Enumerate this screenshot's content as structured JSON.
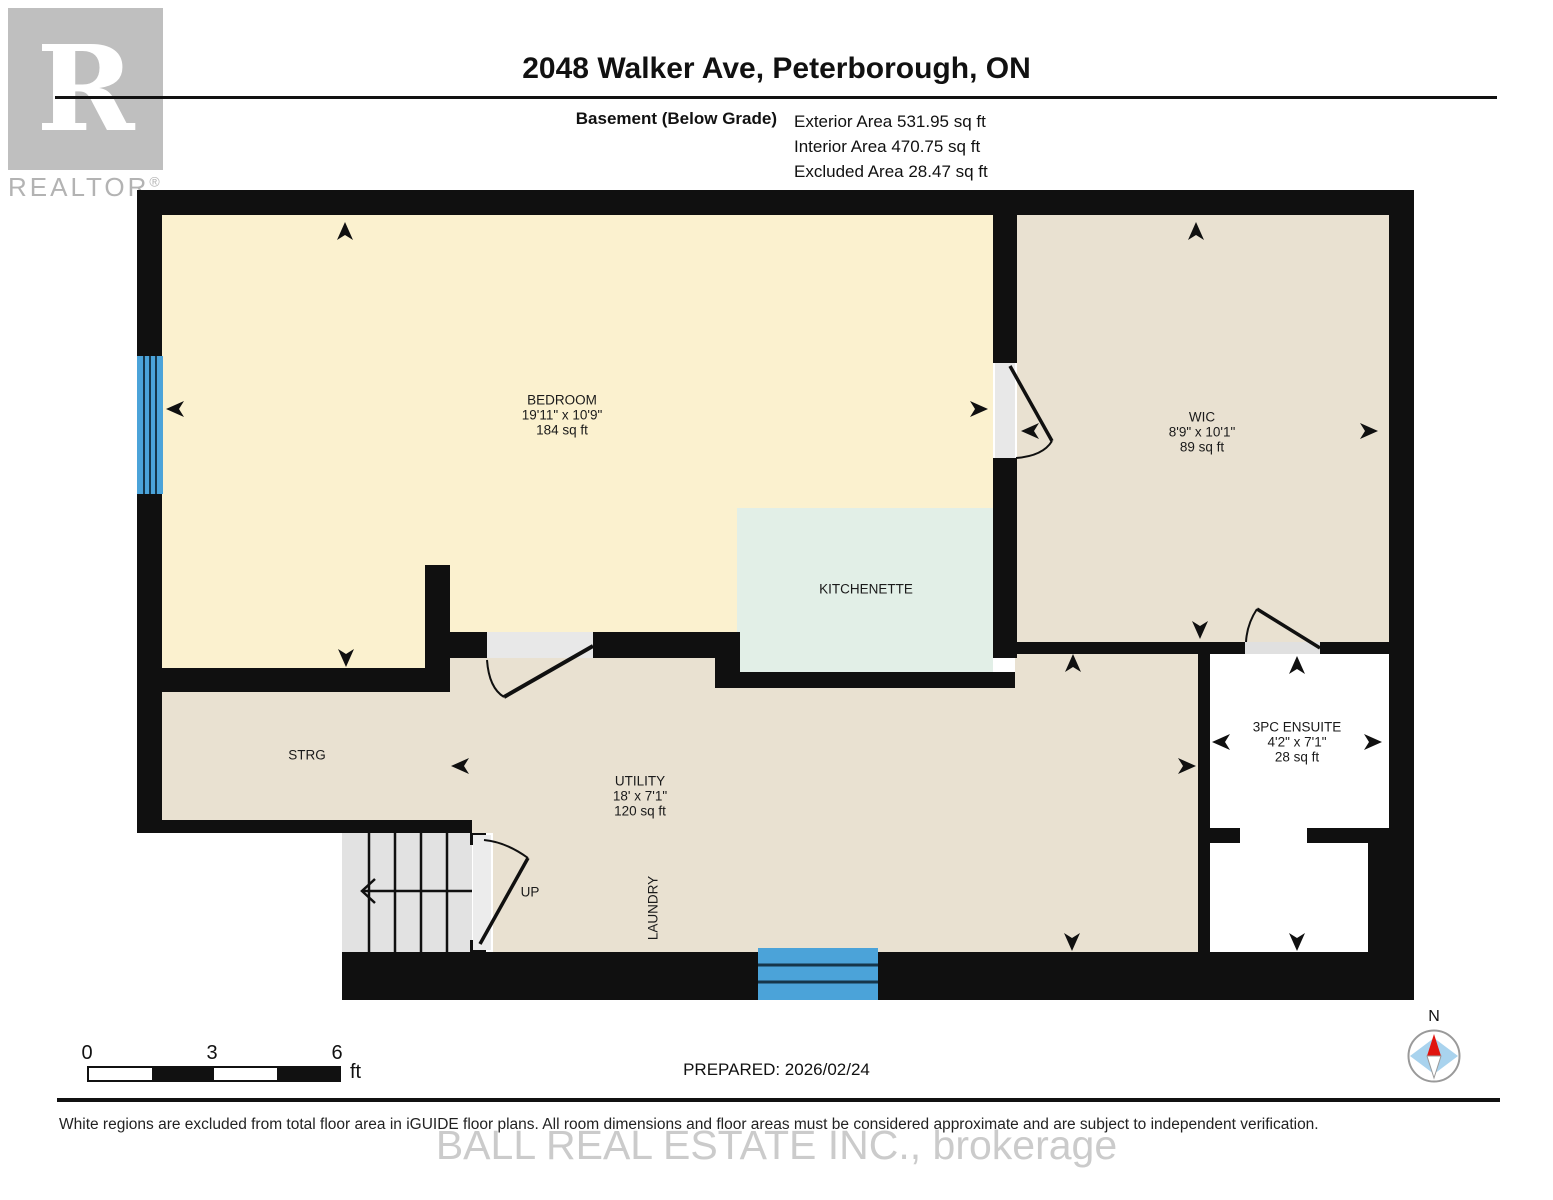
{
  "header": {
    "title": "2048 Walker Ave, Peterborough, ON",
    "floor_label": "Basement (Below Grade)",
    "exterior_area": "Exterior Area 531.95 sq ft",
    "interior_area": "Interior Area 470.75 sq ft",
    "excluded_area": "Excluded Area 28.47 sq ft"
  },
  "logo": {
    "letter": "R",
    "wordmark": "REALTOR",
    "registered": "®"
  },
  "rooms": {
    "bedroom": {
      "name": "BEDROOM",
      "dimensions": "19'11\" x 10'9\"",
      "area": "184 sq ft"
    },
    "wic": {
      "name": "WIC",
      "dimensions": "8'9\" x 10'1\"",
      "area": "89 sq ft"
    },
    "kitchenette": {
      "name": "KITCHENETTE"
    },
    "storage": {
      "name": "STRG"
    },
    "utility": {
      "name": "UTILITY",
      "dimensions": "18' x 7'1\"",
      "area": "120 sq ft"
    },
    "laundry": {
      "name": "LAUNDRY"
    },
    "stairs": {
      "name": "UP"
    },
    "ensuite": {
      "name": "3PC ENSUITE",
      "dimensions": "4'2\" x 7'1\"",
      "area": "28 sq ft"
    }
  },
  "scale_bar": {
    "tick_start": "0",
    "tick_mid": "3",
    "tick_end": "6",
    "unit": "ft"
  },
  "prepared": "PREPARED: 2026/02/24",
  "compass": {
    "north_label": "N"
  },
  "watermark": "BALL REAL ESTATE INC., brokerage",
  "footer": {
    "disclaimer": "White regions are excluded from total floor area in iGUIDE floor plans. All room dimensions and floor areas must be considered approximate and are subject to independent verification."
  },
  "colors": {
    "bedroom_fill": "#FBF1CF",
    "closet_utility_fill": "#E9E1D1",
    "kitchenette_fill": "#E2EFE7",
    "wall": "#101010",
    "window_blue": "#4BA3D9",
    "stairs_gray": "#E2E2E2",
    "compass_blue": "#A9D3EE",
    "compass_red": "#E0140F"
  }
}
